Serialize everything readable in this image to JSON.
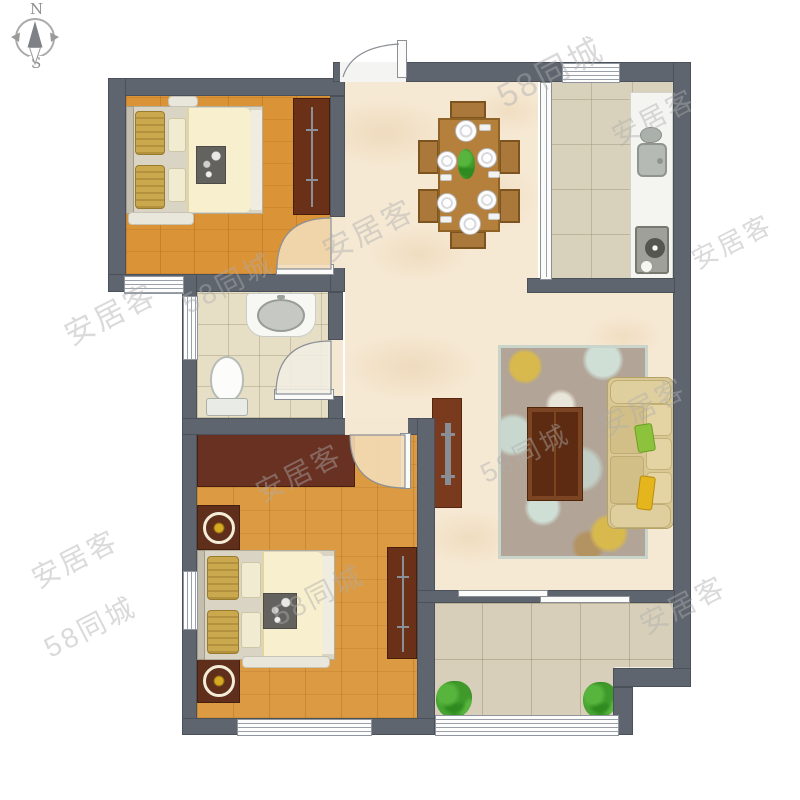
{
  "compass": {
    "north_label": "N",
    "south_label": "S"
  },
  "watermarks": [
    {
      "text": "安居客",
      "x": 60,
      "y": 290,
      "size": 30
    },
    {
      "text": "58同城",
      "x": 178,
      "y": 262,
      "size": 28
    },
    {
      "text": "安居客",
      "x": 318,
      "y": 206,
      "size": 30
    },
    {
      "text": "58同城",
      "x": 492,
      "y": 46,
      "size": 33
    },
    {
      "text": "安居客",
      "x": 608,
      "y": 96,
      "size": 27
    },
    {
      "text": "安居客",
      "x": 688,
      "y": 222,
      "size": 26
    },
    {
      "text": "安居客",
      "x": 596,
      "y": 386,
      "size": 28
    },
    {
      "text": "58同城",
      "x": 476,
      "y": 432,
      "size": 27
    },
    {
      "text": "安居客",
      "x": 252,
      "y": 452,
      "size": 28
    },
    {
      "text": "58同城",
      "x": 268,
      "y": 574,
      "size": 28
    },
    {
      "text": "安居客",
      "x": 28,
      "y": 538,
      "size": 28
    },
    {
      "text": "58同城",
      "x": 40,
      "y": 606,
      "size": 28
    },
    {
      "text": "安居客",
      "x": 636,
      "y": 584,
      "size": 28
    }
  ],
  "palette": {
    "wall": "#5f656e",
    "wood_floor": "#da9336",
    "marble_floor": "#f6e9d4",
    "kitchen_tile": "#d8d1bc",
    "bath_tile": "#e7dec6",
    "balcony_tile": "#d7cfb9",
    "wardrobe": "#6b3118",
    "sofa": "#d9c794",
    "pillow_green": "#8cc23c",
    "pillow_yellow": "#e5b51e",
    "dining_table": "#b5803c",
    "rug": "#b2a496"
  }
}
